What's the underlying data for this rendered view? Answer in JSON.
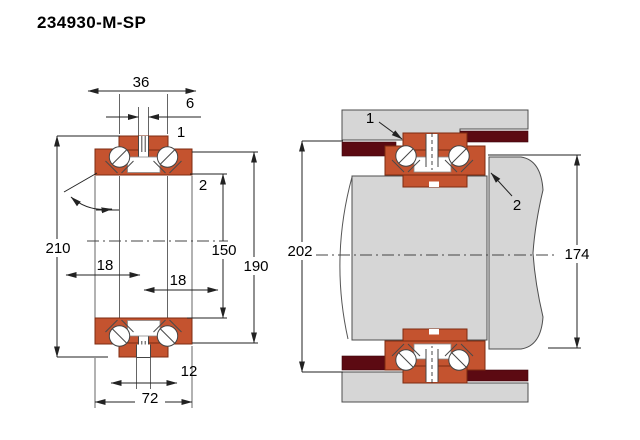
{
  "title": "234930-M-SP",
  "colors": {
    "bearing": "#c4532f",
    "steel": "#d6d6d6",
    "seal": "#5c0a12",
    "line": "#333333",
    "background": "#ffffff"
  },
  "left_view": {
    "description": "bearing cross-section",
    "dims": {
      "top_width": "36",
      "top_groove": "6",
      "outer_diameter": "210",
      "bore_diameter": "150",
      "step_diameter": "190",
      "row_offset_left": "18",
      "row_offset_right": "18",
      "bottom_groove": "12",
      "total_width": "72"
    },
    "labels": {
      "ref1": "1",
      "ref2": "2"
    }
  },
  "right_view": {
    "description": "mounting arrangement",
    "dims": {
      "housing_bore": "202",
      "sleeve_od": "174"
    },
    "labels": {
      "ref1": "1",
      "ref2": "2"
    }
  }
}
